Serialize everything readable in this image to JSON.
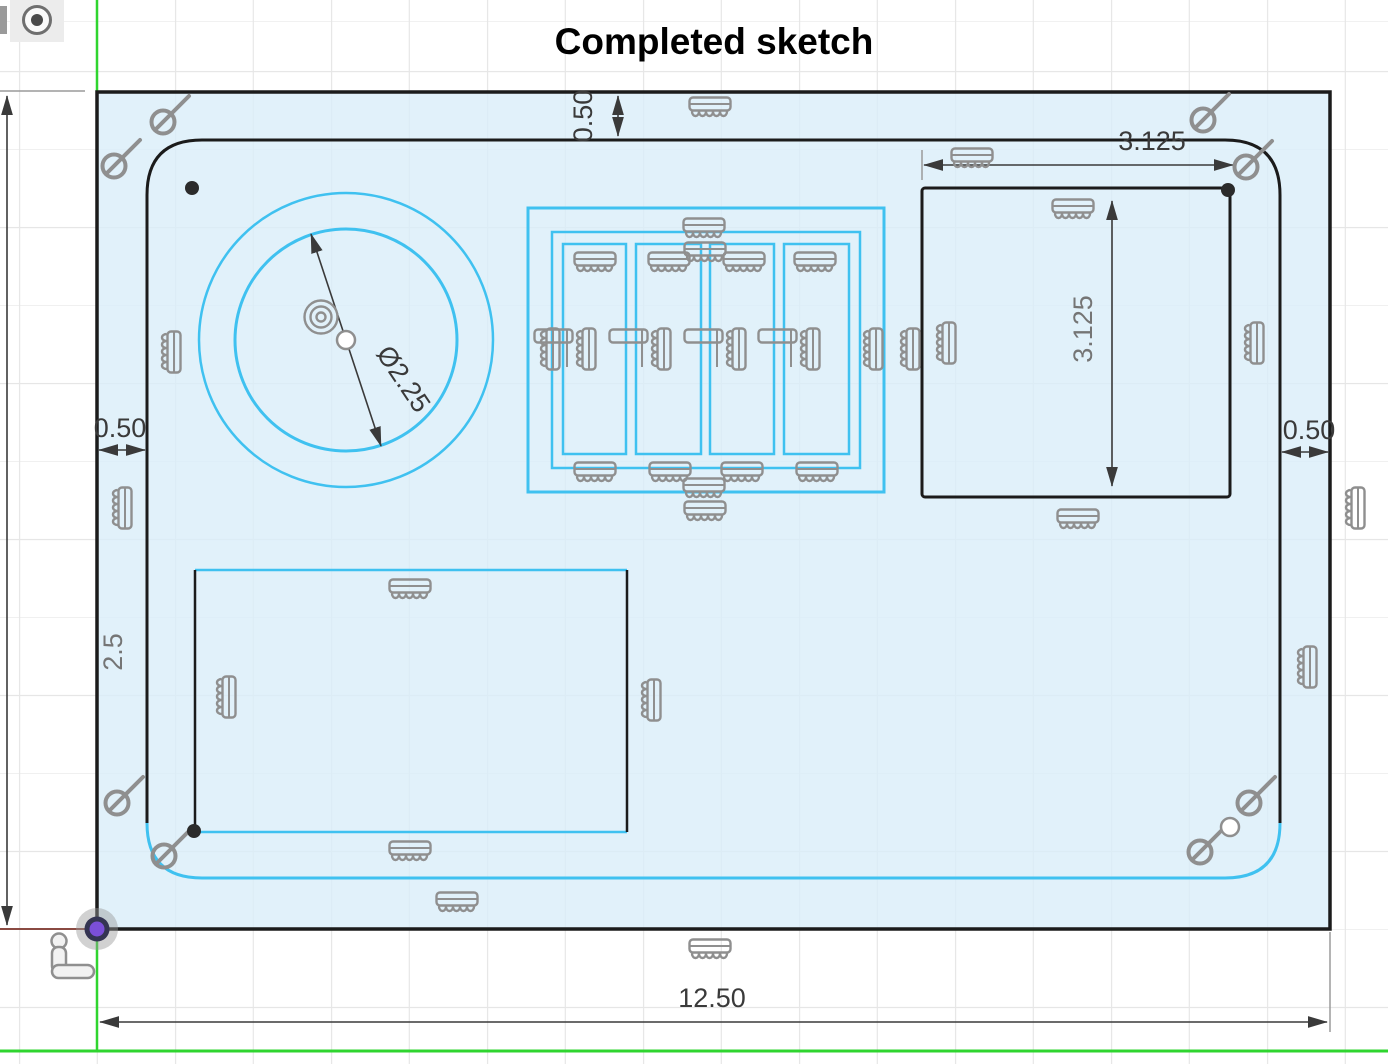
{
  "title": "Completed sketch",
  "dimensions": {
    "top_wall": "0.50",
    "left_wall": "0.50",
    "right_wall": "0.50",
    "pocket_offset_left": "2.5",
    "overall_width": "12.50",
    "square_pocket_width": "3.125",
    "square_pocket_height": "3.125",
    "hole_diameter": "Ø2.25"
  },
  "colors": {
    "sketch_curve_blue": "#3FC1F0",
    "fixed_curve_black": "#1B1B1B",
    "profile_fill_light_blue": "#E8F3FA",
    "constraint_icon_gray": "#8F8F8F",
    "axis_green": "#2FD52F",
    "x_axis_red": "#8A4A42",
    "dimension_text_dark": "#3A3A3A",
    "dimension_text_gray": "#757575",
    "origin_point_purple": "#7B4FD8"
  },
  "icons": {
    "fix_ground_constraint": "comb-ground-icon",
    "tangent_constraint": "tangent-icon",
    "concentric_constraint": "concentric-icon",
    "coincident_point": "point-dot",
    "origin": "origin-point-icon",
    "axis_marker": "axis-l-icon",
    "view_tool": "view-indicator-icon"
  }
}
